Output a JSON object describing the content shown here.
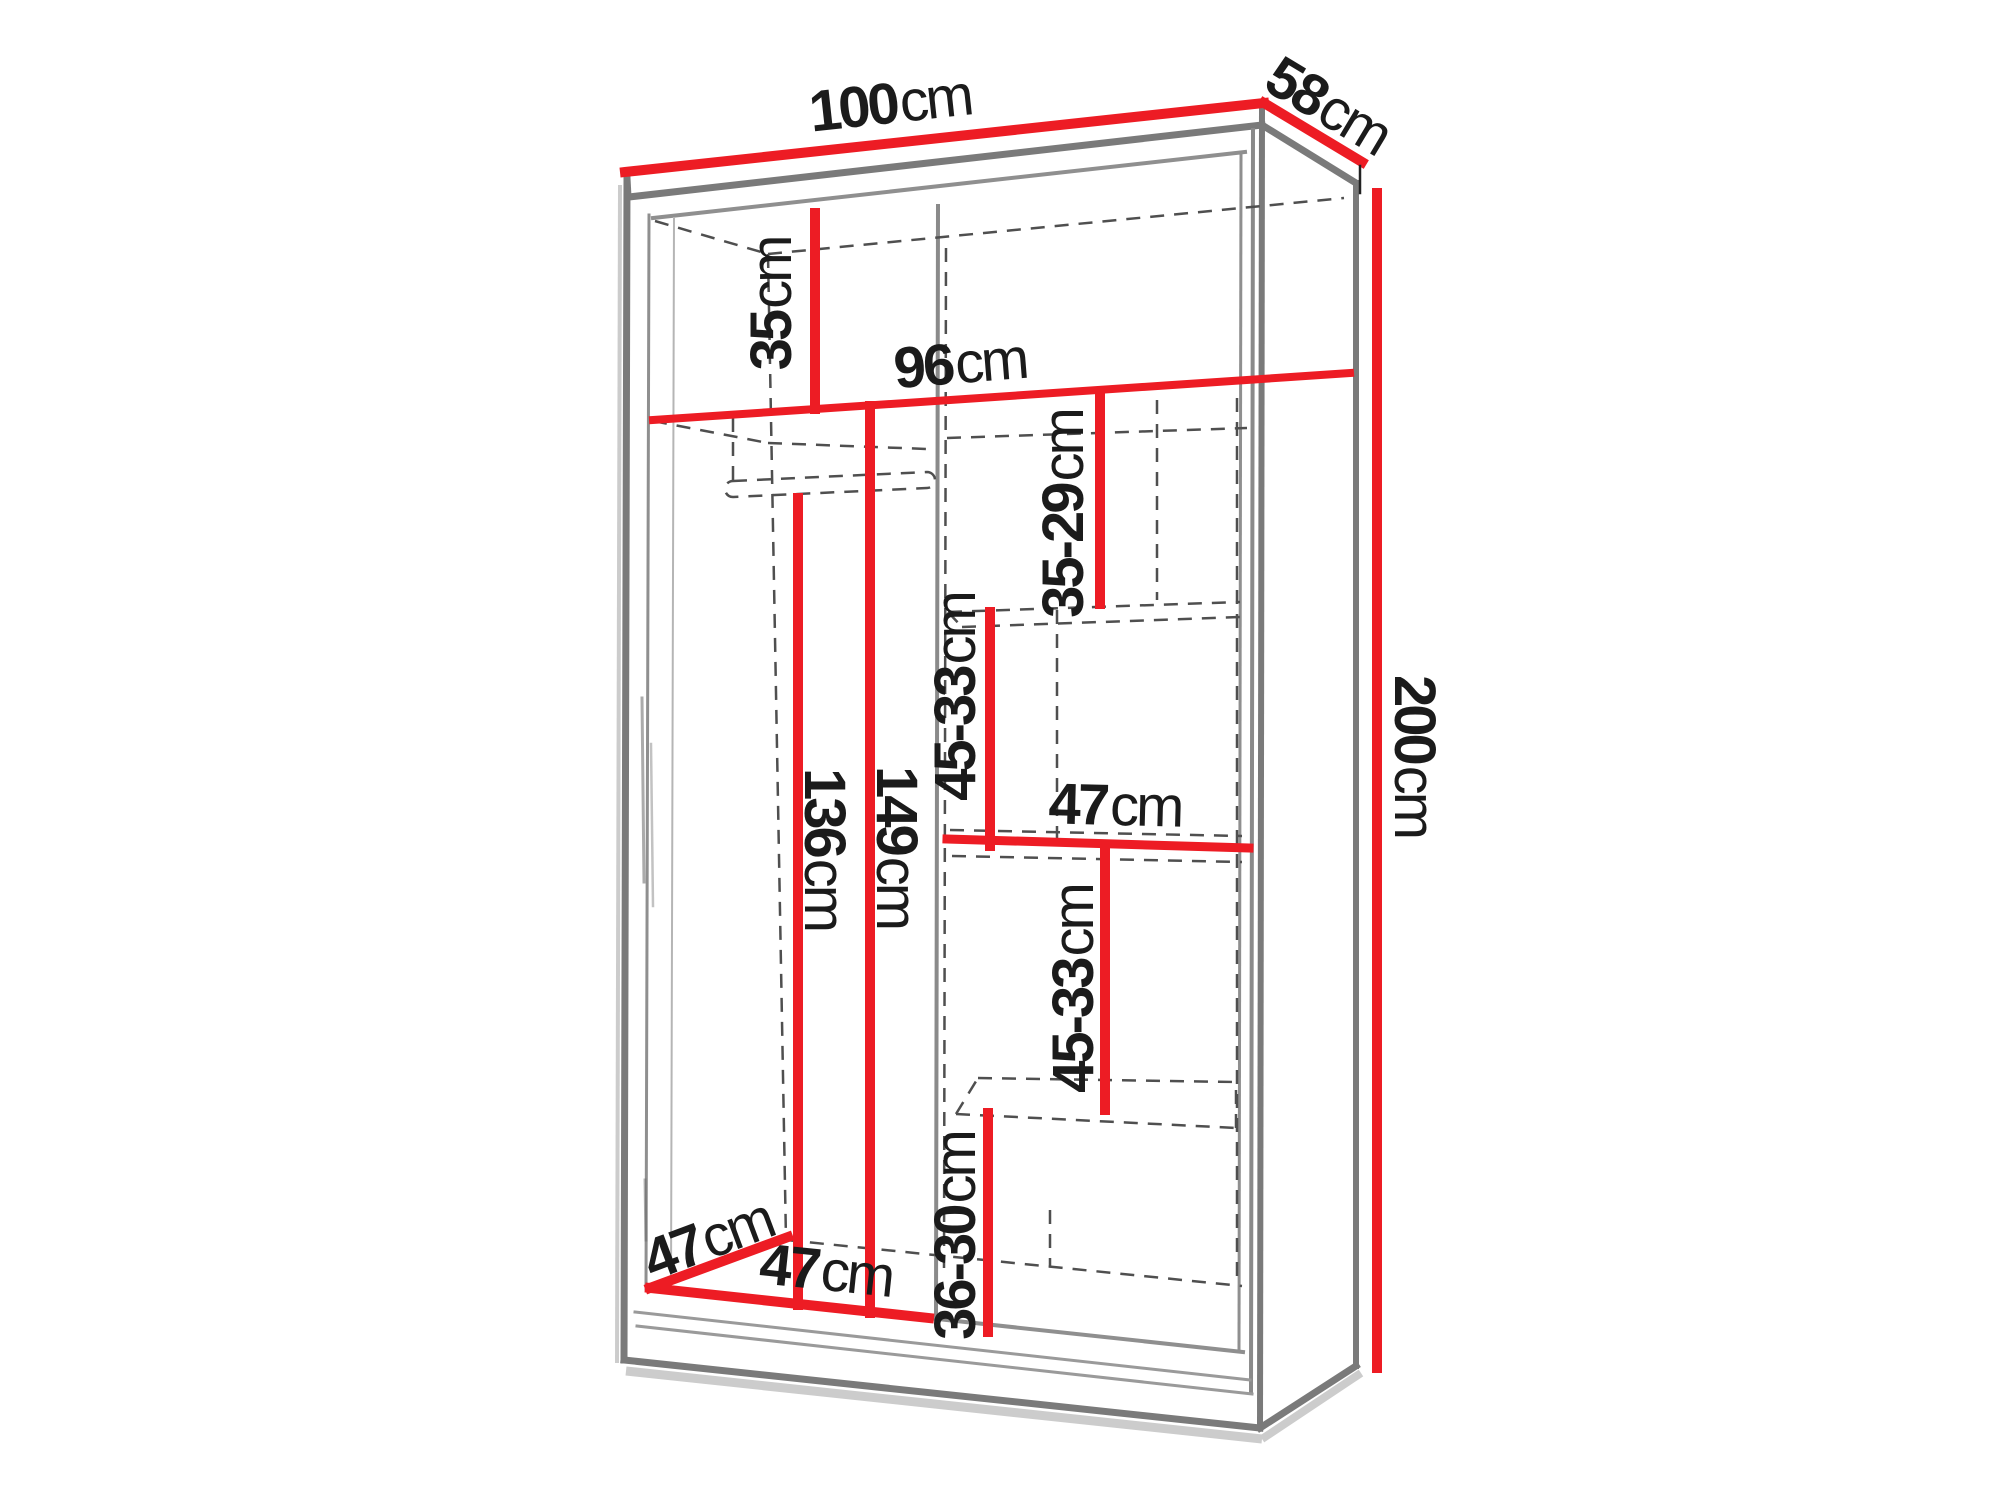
{
  "diagram": {
    "kind": "wardrobe-dimension-diagram",
    "unit": "cm"
  },
  "colors": {
    "dimension_red": "#ed1c24",
    "outline_gray": "#7a7a7a",
    "inner_gray": "#8f8f8f",
    "dashed_gray": "#4f4f4f",
    "label_text": "#1b1b1b",
    "background": "#ffffff"
  },
  "labels": {
    "total_width": {
      "value": "100",
      "unit": "cm"
    },
    "total_depth": {
      "value": "58",
      "unit": "cm"
    },
    "total_height": {
      "value": "200",
      "unit": "cm"
    },
    "top_gap": {
      "value": "35",
      "unit": "cm"
    },
    "interior_width": {
      "value": "96",
      "unit": "cm"
    },
    "gap_35_29": {
      "value": "35-29",
      "unit": "cm"
    },
    "gap_45_33_upper": {
      "value": "45-33",
      "unit": "cm"
    },
    "shelf_width": {
      "value": "47",
      "unit": "cm"
    },
    "gap_45_33_lower": {
      "value": "45-33",
      "unit": "cm"
    },
    "gap_36_30": {
      "value": "36-30",
      "unit": "cm"
    },
    "hanging_height_left": {
      "value": "136",
      "unit": "cm"
    },
    "hanging_height_right": {
      "value": "149",
      "unit": "cm"
    },
    "left_section_width": {
      "value": "47",
      "unit": "cm"
    },
    "interior_depth": {
      "value": "47",
      "unit": "cm"
    }
  }
}
